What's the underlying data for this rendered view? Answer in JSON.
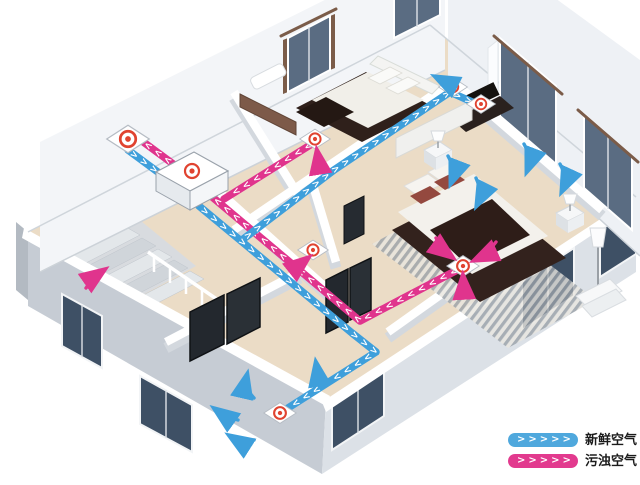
{
  "colors": {
    "fresh_air": "#3E9FDB",
    "polluted_air": "#E0348D",
    "vent_ring": "#E04330",
    "wall_white": "#F2F4F7",
    "floor_wood": "#EBDCC6",
    "window_glass": "#5A6C82",
    "wood_dark": "#33221D"
  },
  "legend": {
    "items": [
      {
        "id": "fresh-air",
        "label": "新鲜空气",
        "chevrons": ">>>>>",
        "color": "#4FA8DD"
      },
      {
        "id": "polluted-air",
        "label": "污浊空气",
        "chevrons": ">>>>>",
        "color": "#E23A8E"
      }
    ]
  },
  "ducts": {
    "chevrons": {
      "b1": ">>>>",
      "b2": ">>>>>>>>>>>>>>>>>>>>>>>>>>>>>>>>",
      "b3": ">>>>>>>>>>>>>>>>>>>>>>>>>",
      "b3s": ">>",
      "p1": ">>>>",
      "p2": ">>>>>>>>>>",
      "p3": ">>>>>>>>>>>>>>>>>>>>>>>>>>>>>>"
    }
  }
}
